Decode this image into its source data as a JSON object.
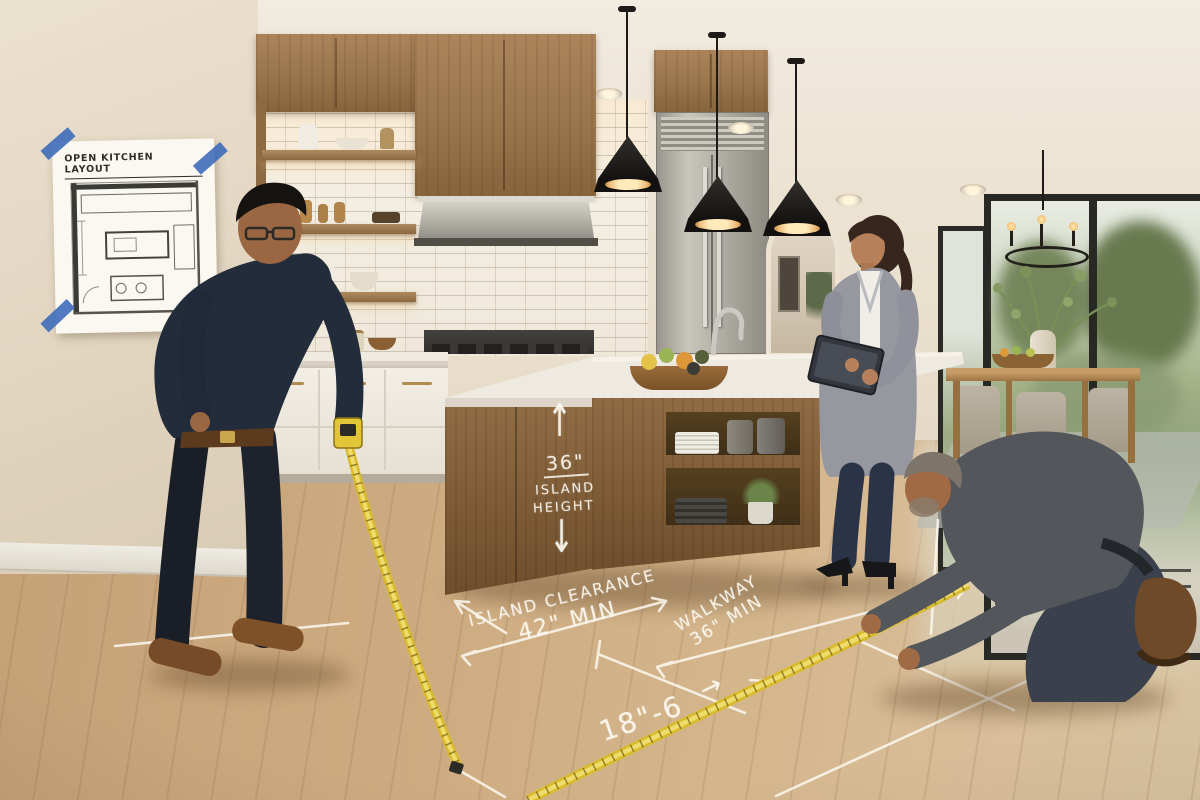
{
  "scene": {
    "title": "Open kitchen measuring session",
    "description": "Two contractors measure island clearance and walkway widths with tape measures on the kitchen floor while a designer reviews the layout on a tablet."
  },
  "wall_poster": {
    "title": "OPEN KITCHEN LAYOUT"
  },
  "island_annotation": {
    "arrow_up": "↑",
    "value": "36\"",
    "label_line1": "ISLAND",
    "label_line2": "HEIGHT",
    "arrow_down": "↓"
  },
  "floor_annotations": {
    "island_clearance": {
      "label": "ISLAND CLEARANCE",
      "value": "42\" MIN"
    },
    "walkway": {
      "label": "WALKWAY",
      "value": "36\" MIN"
    },
    "run_length": {
      "value": "18\"-6",
      "arrow": "→"
    }
  },
  "colors": {
    "tape_measure_yellow": "#e7c93b",
    "chalk_white": "#f7f3ea",
    "cabinet_wood": "#9a7648",
    "island_marble": "#ece7dd",
    "pendant_black": "#211e1b",
    "blueprint_tape_blue": "#3e6cba",
    "floor_oak": "#cfae86"
  }
}
